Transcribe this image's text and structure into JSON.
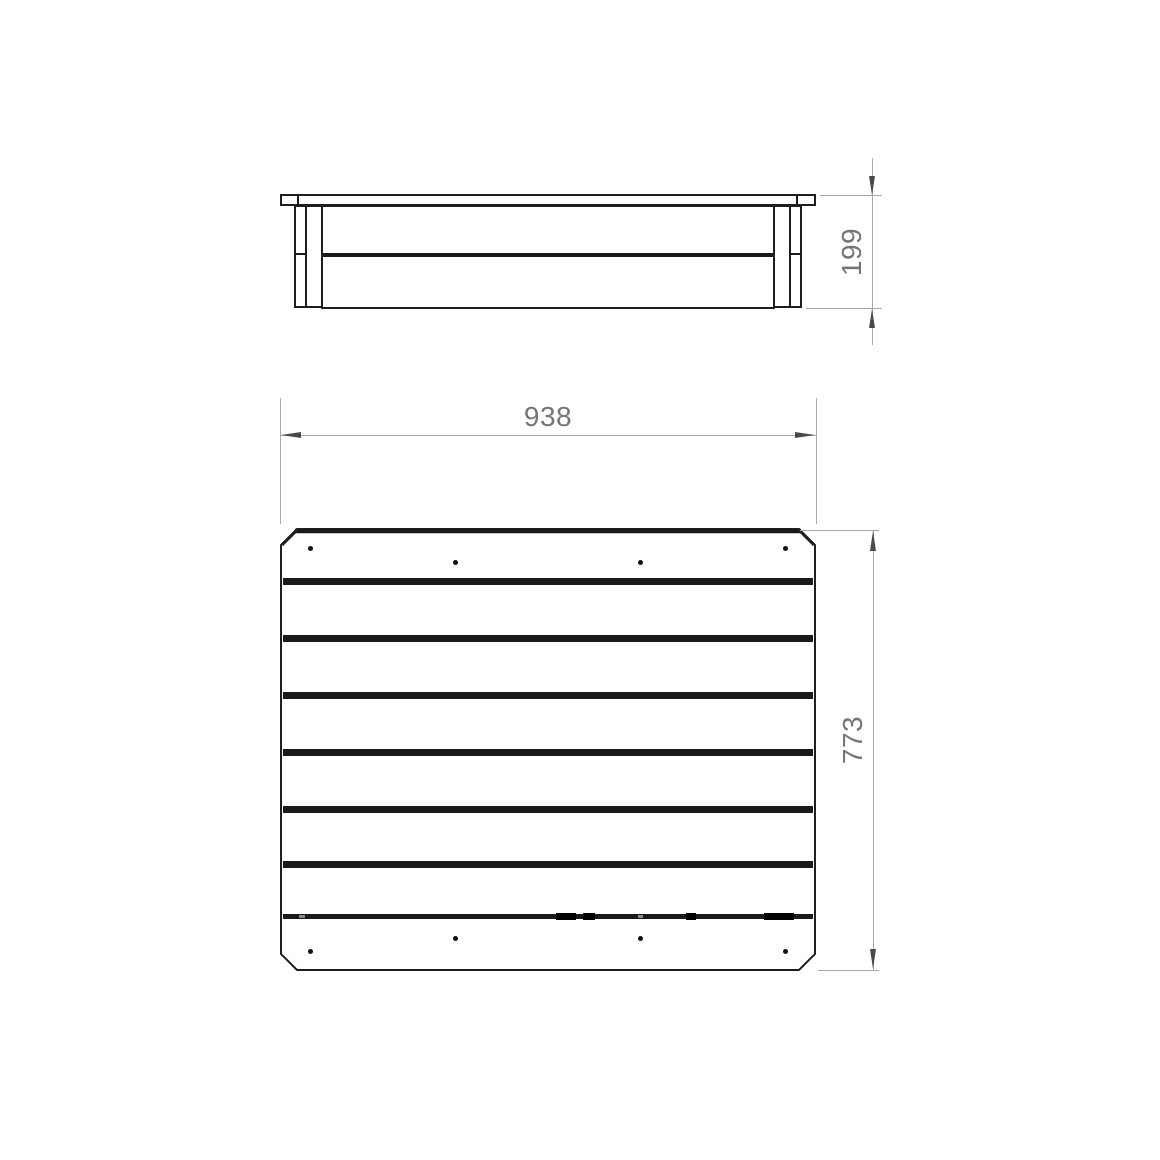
{
  "drawing": {
    "colors": {
      "background": "#ffffff",
      "object_line": "#1f1f1f",
      "separator_fill": "#1a1a1a",
      "dimension_line": "#a9a9a9",
      "dimension_text": "#757575",
      "arrowhead": "#4a4a4a"
    },
    "views": {
      "side_elevation": {
        "plank_rows": 2,
        "height_dim": {
          "value": "199",
          "orientation": "vertical"
        }
      },
      "plan": {
        "plank_rows": 6,
        "screw_dots_top_board": 4,
        "screw_dots_bottom_board": 4,
        "width_dim": {
          "value": "938",
          "orientation": "horizontal"
        },
        "depth_dim": {
          "value": "773",
          "orientation": "vertical"
        }
      }
    }
  }
}
